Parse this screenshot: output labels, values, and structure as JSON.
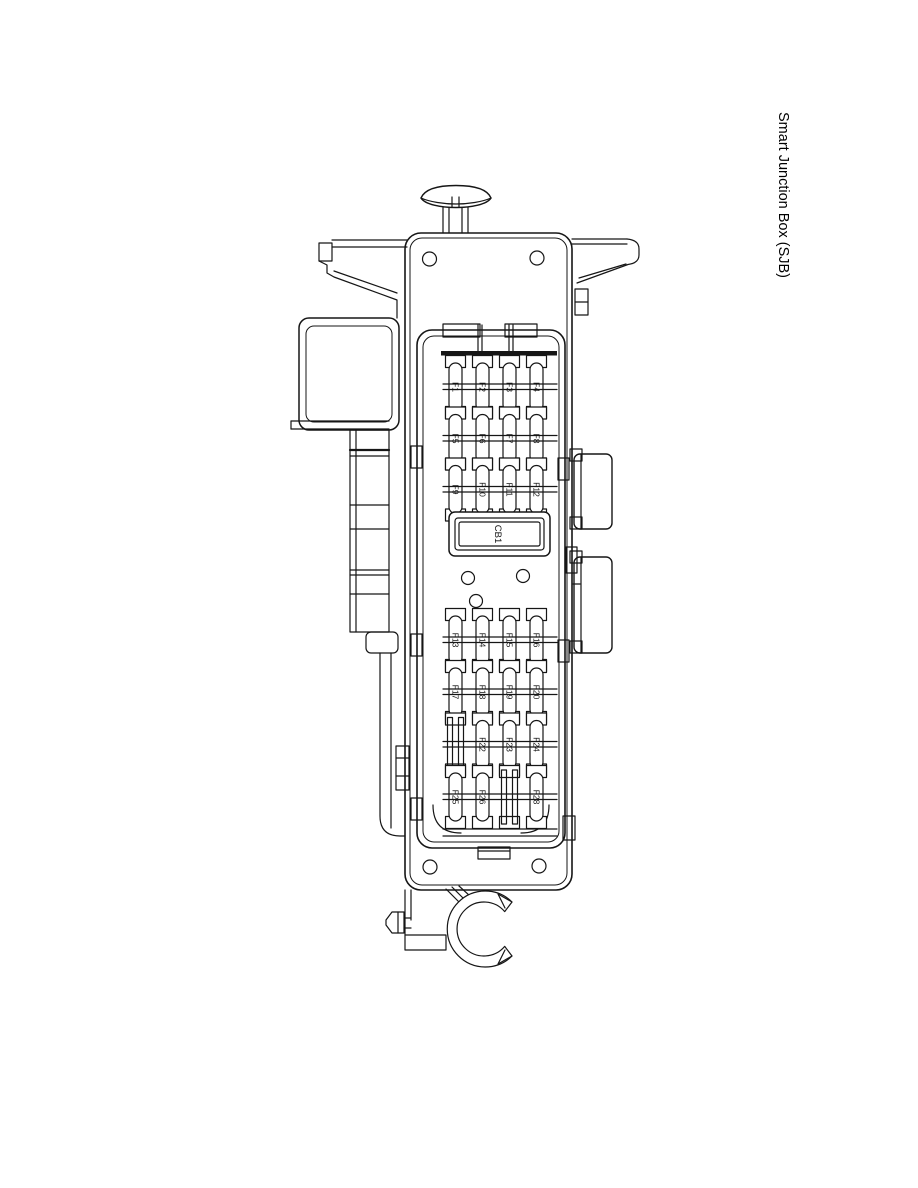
{
  "page": {
    "title_vertical": "Smart Junction Box (SJB)",
    "background": "#ffffff"
  },
  "diagram": {
    "component": "smart-junction-box-line-drawing",
    "line_color": "#161616",
    "breaker_label": "CB1",
    "top_fuse_rows": [
      [
        "F1",
        "F2",
        "F3",
        "F4"
      ],
      [
        "F5",
        "F6",
        "F7",
        "F8"
      ],
      [
        "F9",
        "F10",
        "F11",
        "F12"
      ]
    ],
    "bottom_fuse_rows": [
      [
        "F13",
        "F14",
        "F15",
        "F16"
      ],
      [
        "F17",
        "F18",
        "F19",
        "F20"
      ],
      [
        "",
        "F22",
        "F23",
        "F24"
      ],
      [
        "F25",
        "F26",
        "",
        "F28"
      ]
    ]
  }
}
